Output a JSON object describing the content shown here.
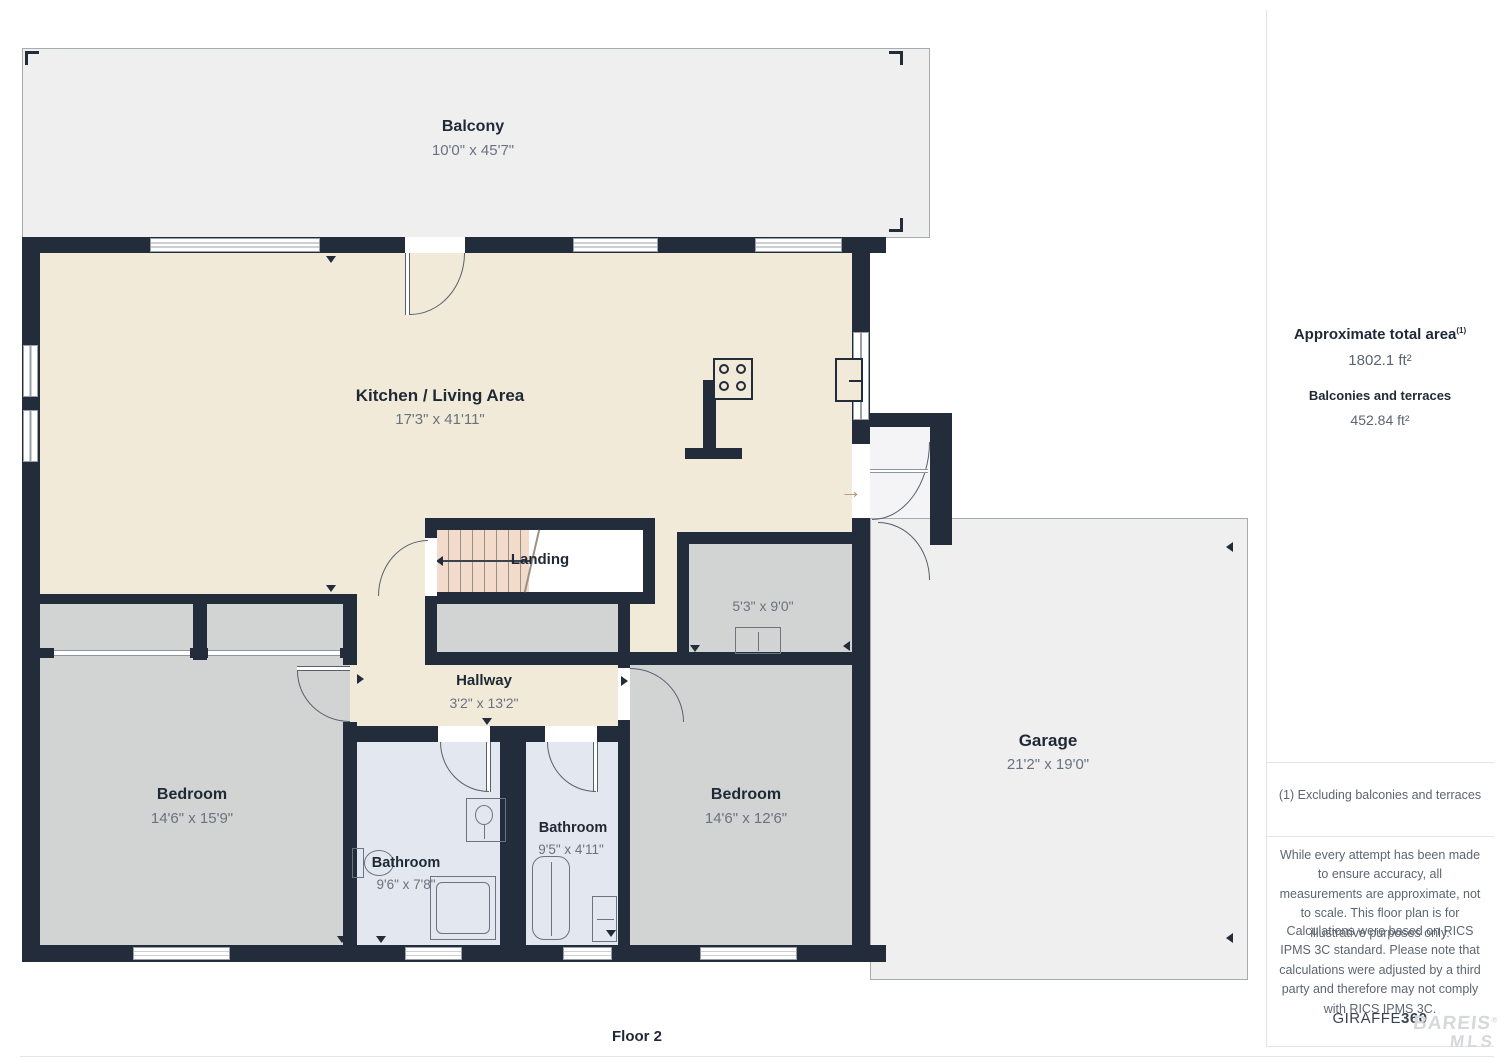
{
  "meta": {
    "floor_label": "Floor 2",
    "brand": {
      "giraffe": "GIRAFFE",
      "threesixty": "360"
    },
    "watermark": {
      "line1": "BAREIS",
      "reg": "®",
      "line2": "MLS"
    }
  },
  "icons": {
    "entry_arrow": "→"
  },
  "rooms": {
    "balcony": {
      "name": "Balcony",
      "dims": "10'0\" x 45'7\""
    },
    "kitchen": {
      "name": "Kitchen / Living Area",
      "dims": "17'3\" x 41'11\""
    },
    "landing": {
      "name": "Landing"
    },
    "hallway": {
      "name": "Hallway",
      "dims": "3'2\" x 13'2\""
    },
    "closet": {
      "dims": "5'3\" x 9'0\""
    },
    "bedroom_left": {
      "name": "Bedroom",
      "dims": "14'6\" x 15'9\""
    },
    "bathroom_left": {
      "name": "Bathroom",
      "dims": "9'6\" x 7'8\""
    },
    "bathroom_mid": {
      "name": "Bathroom",
      "dims": "9'5\" x 4'11\""
    },
    "bedroom_right": {
      "name": "Bedroom",
      "dims": "14'6\" x 12'6\""
    },
    "garage": {
      "name": "Garage",
      "dims": "21'2\" x 19'0\""
    }
  },
  "sidebar": {
    "total_area_label": "Approximate total area",
    "total_area_superscript": "(1)",
    "total_area_value": "1802.1 ft²",
    "balconies_label": "Balconies and terraces",
    "balconies_value": "452.84 ft²",
    "footnote": "(1) Excluding balconies and terraces",
    "disclaimer1": "While every attempt has been made to ensure accuracy, all measurements are approximate, not to scale. This floor plan is for illustrative purposes only.",
    "disclaimer2": "Calculations were based on RICS IPMS 3C standard. Please note that calculations were adjusted by a third party and therefore may not comply with RICS IPMS 3C."
  },
  "colors": {
    "wall": "#222c3a",
    "kitchen_fill": "#f1ead8",
    "bedroom_fill": "#d2d3d3",
    "bathroom_fill": "#e3e7ef",
    "balcony_garage_fill": "#efeff0",
    "stairs_fill": "#f3dbcb",
    "dim_text": "#6a7280",
    "label_text": "#1f2935",
    "sidebar_text": "#5d6571",
    "watermark": "#d6d8dc"
  }
}
